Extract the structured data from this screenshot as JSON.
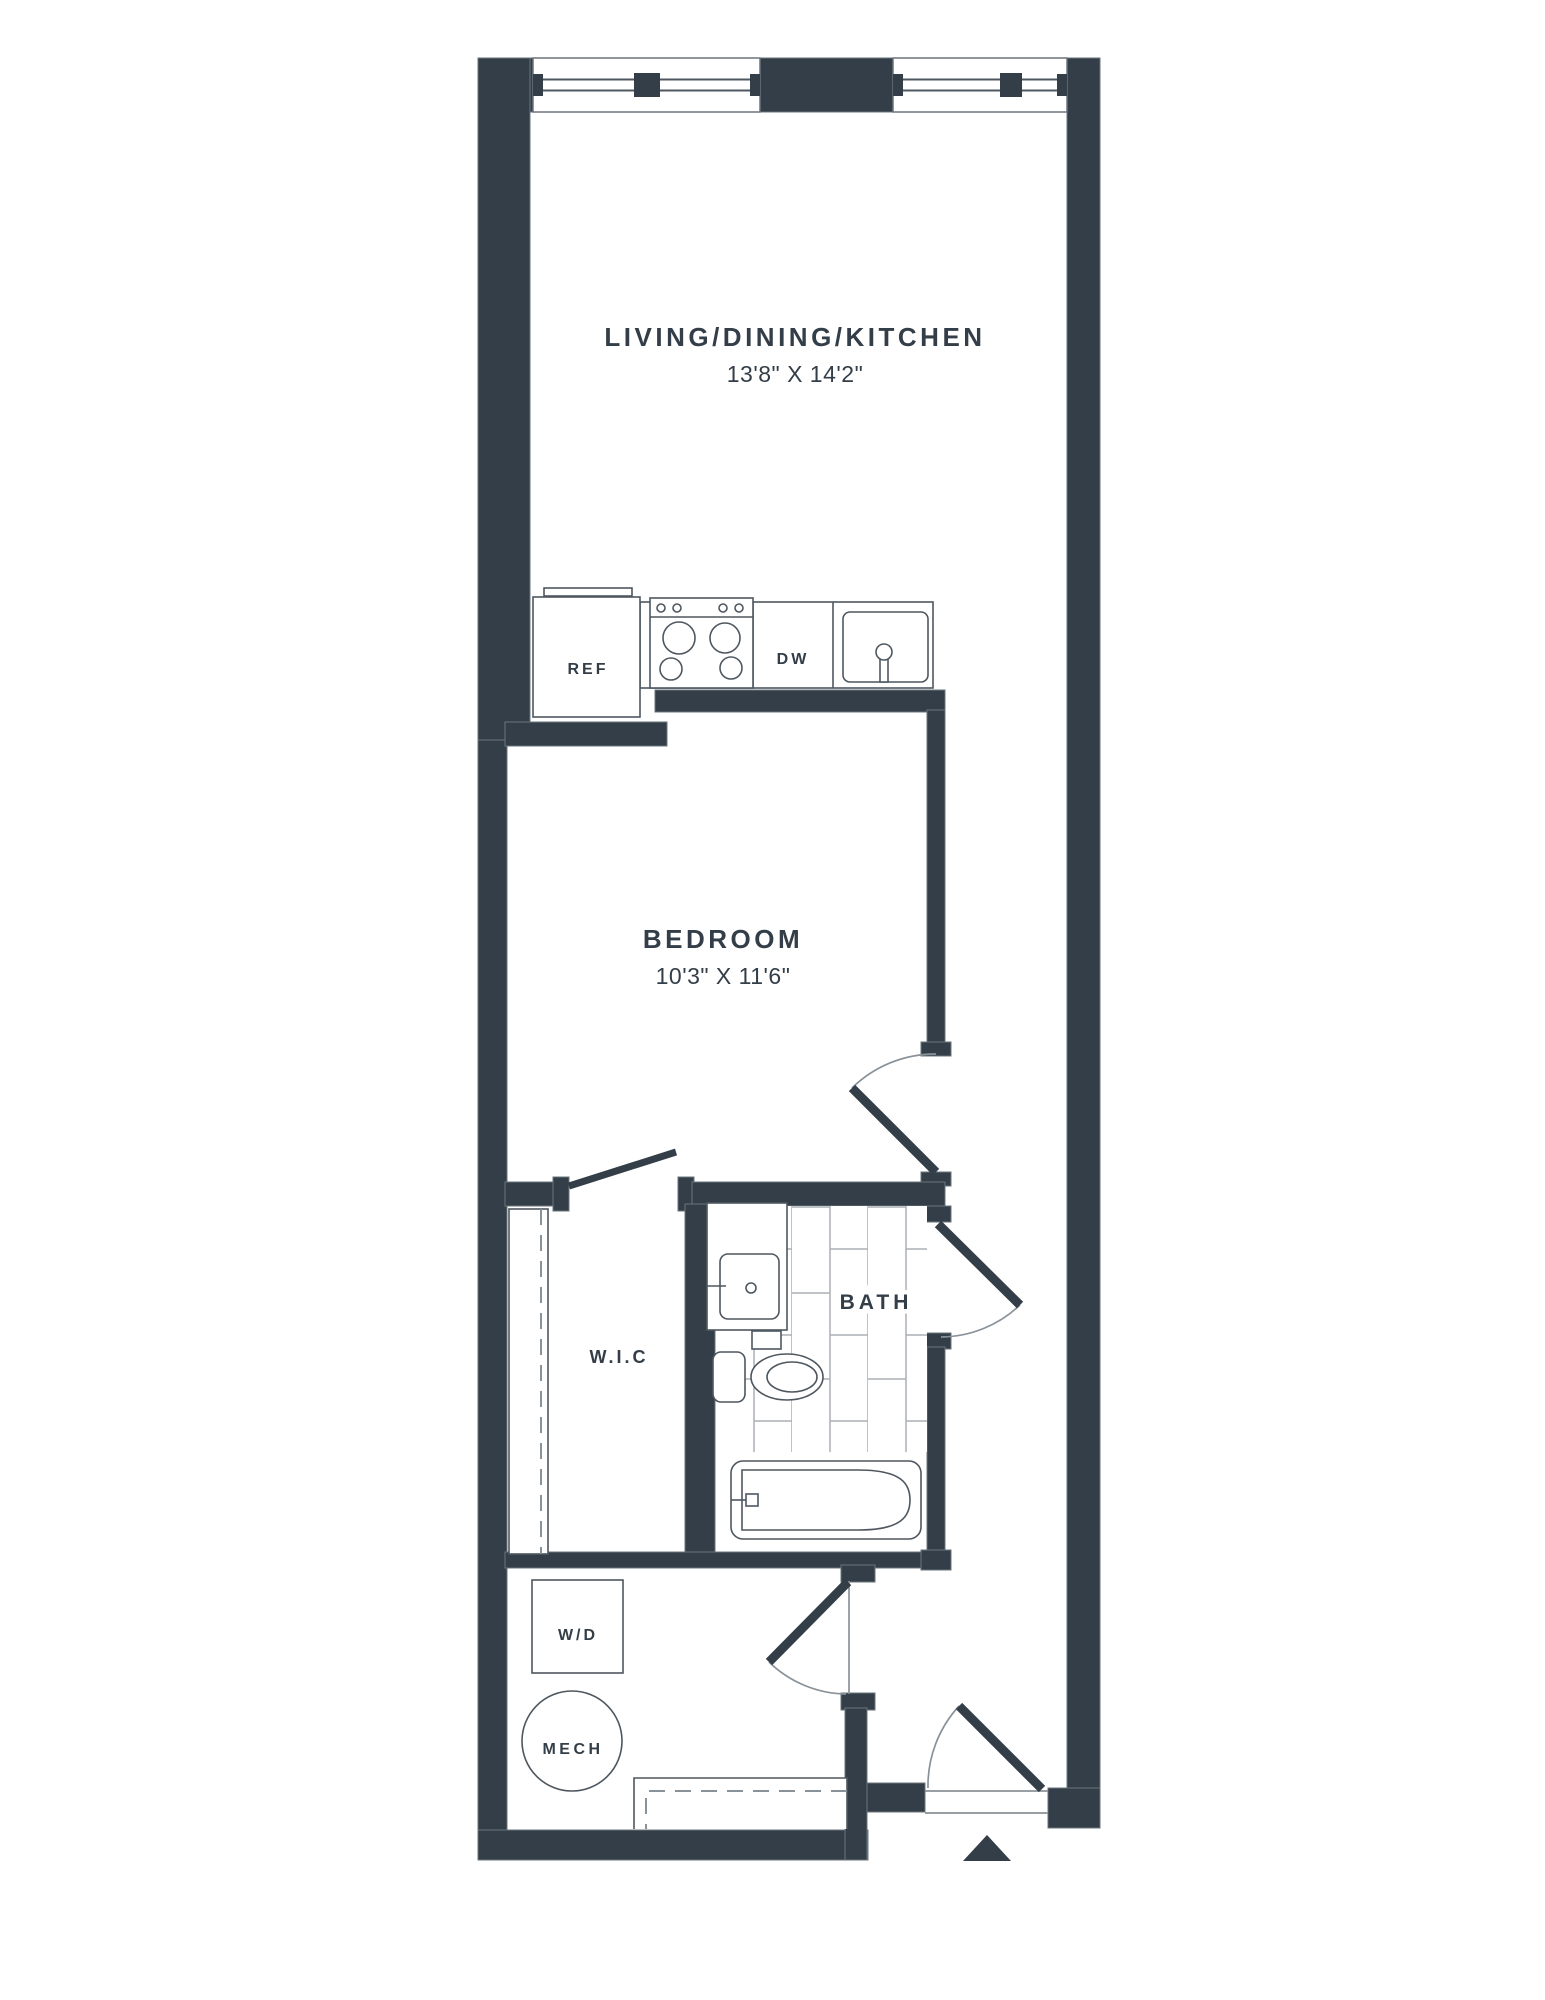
{
  "floorplan": {
    "rooms": {
      "living": {
        "label": "LIVING/DINING/KITCHEN",
        "dims": "13'8\" X 14'2\""
      },
      "bedroom": {
        "label": "BEDROOM",
        "dims": "10'3\" X 11'6\""
      },
      "wic": {
        "label": "W.I.C"
      },
      "bath": {
        "label": "BATH"
      }
    },
    "appliances": {
      "refrigerator": {
        "label": "REF"
      },
      "dishwasher": {
        "label": "DW"
      },
      "washer_dryer": {
        "label": "W/D"
      },
      "mechanical": {
        "label": "MECH"
      }
    },
    "icons": {
      "entry_marker": "triangle-up-arrow"
    },
    "colors": {
      "background": "#FFFFFF",
      "wall": "#333E48",
      "wall_edge": "#6B747C",
      "fixture_line": "#4E575F",
      "light_line": "#8A9299",
      "tile_line": "#ABB1B6",
      "text": "#333E48"
    }
  }
}
